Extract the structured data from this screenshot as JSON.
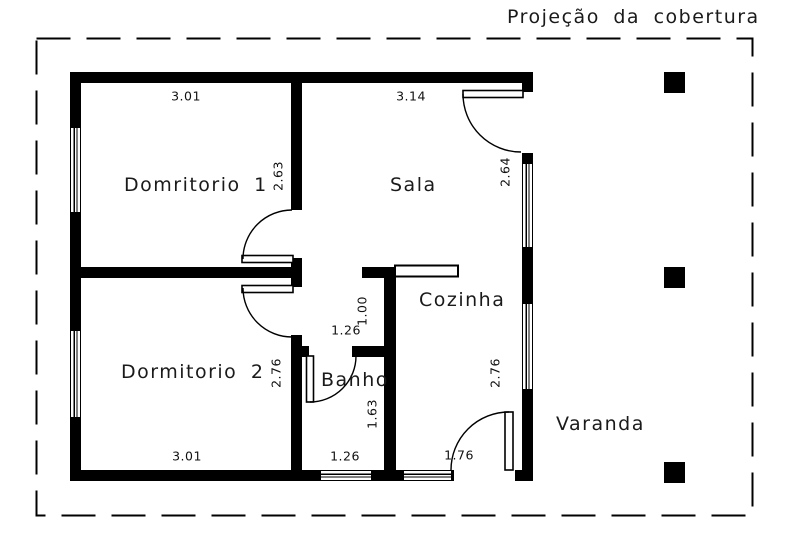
{
  "labels": {
    "roof": "Projeção da cobertura",
    "dormitorio1": "Domritorio 1",
    "sala": "Sala",
    "dormitorio2": "Dormitorio 2",
    "banho": "Banho",
    "cozinha": "Cozinha",
    "varanda": "Varanda"
  },
  "dimensions": {
    "dormitorio1_width": "3.01",
    "dormitorio1_height": "2.63",
    "sala_width": "3.14",
    "sala_height": "2.64",
    "hall_width": "1.26",
    "hall_height": "1.00",
    "dormitorio2_width": "3.01",
    "dormitorio2_height": "2.76",
    "banho_width": "1.26",
    "banho_height": "1.63",
    "cozinha_height": "2.76",
    "cozinha_door_width": "1.76"
  },
  "colors": {
    "line": "#000000",
    "background": "#ffffff"
  }
}
